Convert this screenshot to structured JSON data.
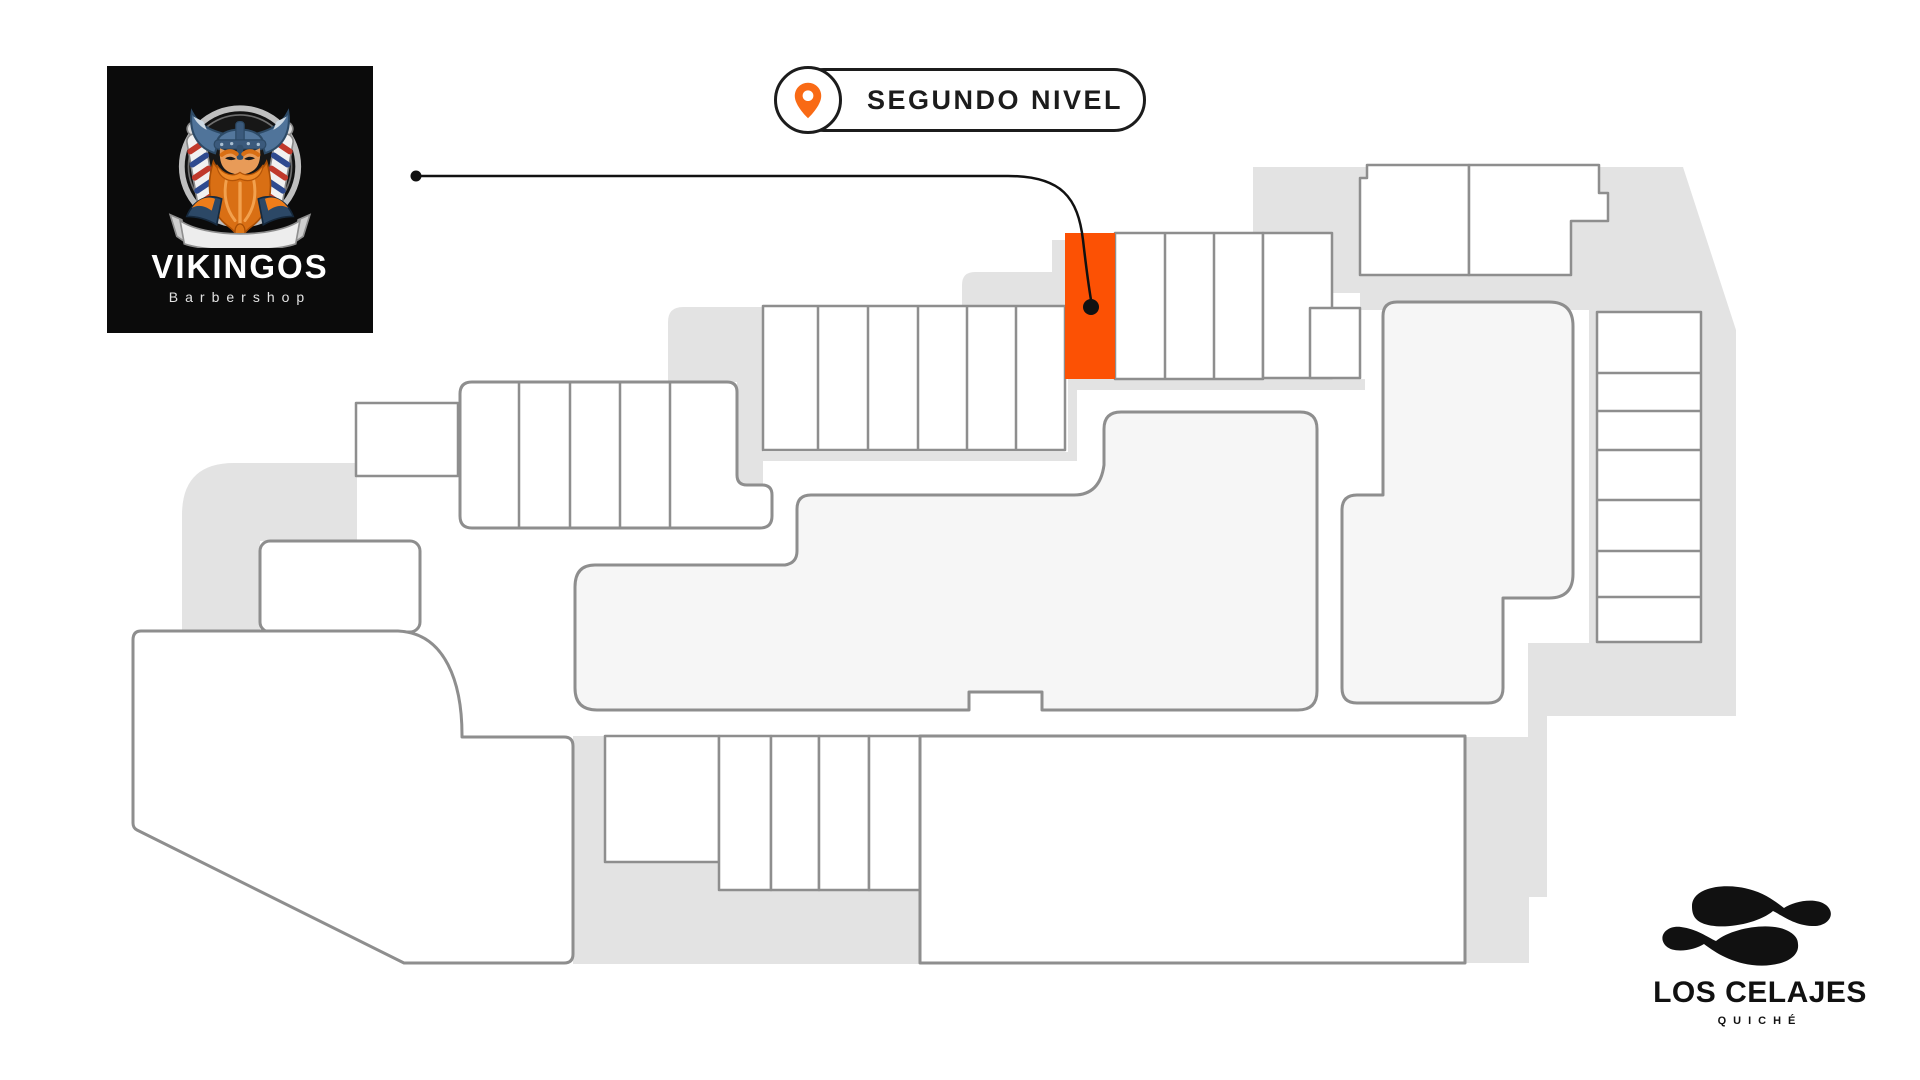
{
  "badge": {
    "label": "SEGUNDO NIVEL"
  },
  "vikingos_logo": {
    "name": "VIKINGOS",
    "tagline": "Barbershop"
  },
  "celajes_logo": {
    "name": "LOS CELAJES",
    "tagline": "QUICHÉ"
  },
  "colors": {
    "highlight_unit": "#FC5104",
    "pin": "#F96A15",
    "map_gray": "#E3E3E3",
    "unit_fill": "#FFFFFF",
    "building_fill": "#F6F6F6",
    "unit_outline": "#8E8E8E",
    "callout": "#111111",
    "badge_border": "#1C1C1C"
  }
}
